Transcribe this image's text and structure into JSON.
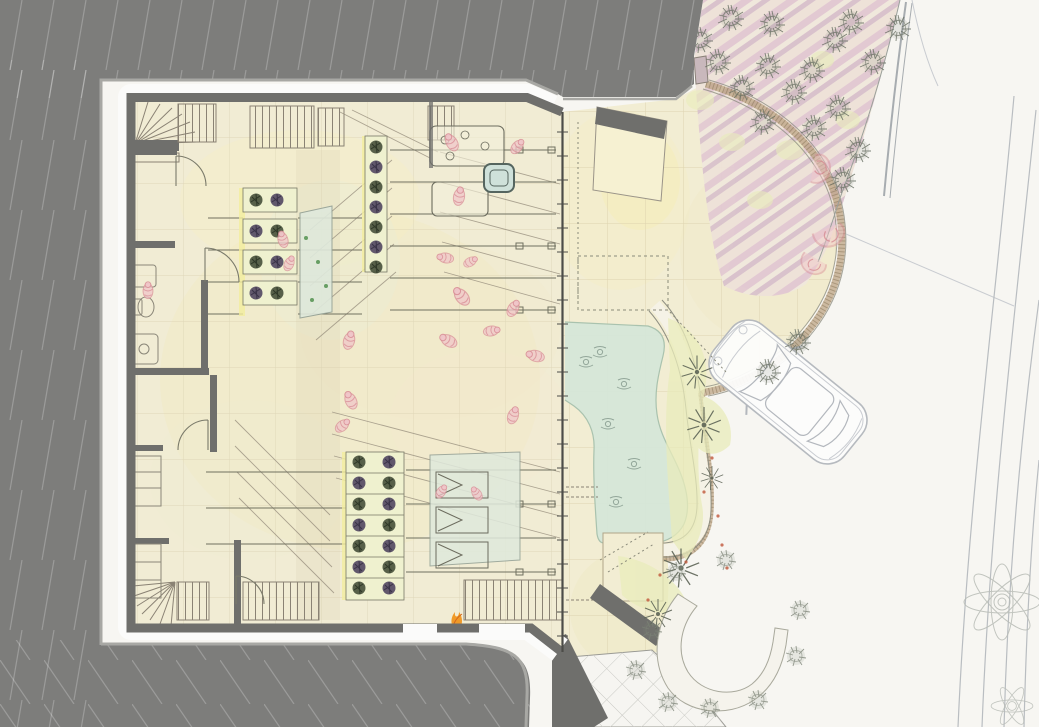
{
  "meta": {
    "title": "hand-rendered architectural site plan",
    "canvas": {
      "width": 1039,
      "height": 727
    },
    "drawing_type": "ground-floor plan with landscape, watercolor and pencil rendering"
  },
  "palette": {
    "white": "#f7f6f2",
    "hill": "#7d7d7b",
    "hill_line": "rgba(250,250,250,0.24)",
    "hill_edge": "#a8a8a4",
    "halo": "#fbfbfa",
    "wall": "#6f6f6c",
    "glazing": "#4c4c48",
    "floor": "#f1ecd4",
    "floor_line": "#d5cbab",
    "terrace": "#f2edd3",
    "terrace_line": "#d6cba6",
    "pond": "#d5e7d8",
    "pond_edge": "#a9c2ae",
    "path": "#f5f2e6",
    "path_edge": "#8f8f82",
    "band": "#b99f7e",
    "band_dot": "#8d7a5c",
    "pink1": "#eee2d8",
    "pink2": "#e2c9d2",
    "pink3": "#f0e8dc",
    "pink4": "#d9c2cc",
    "planting": "#e9ecbb",
    "planter_bed": "#eff1cf",
    "planter_glow": "#f2ee9e",
    "bush_green": "#46503a",
    "bush_purple": "#514760",
    "glass": "#dfe9dc",
    "tree": "#6a7164",
    "palm": "#5d6456",
    "shrub": "#7c8376",
    "people": "#d98f97",
    "people_fill": "#f0c6c9",
    "fire": "#f09a28",
    "fire_dark": "#d2661e",
    "car_line": "#b3b7bd",
    "pencil": "#c9ccd1",
    "road_line": "#b9bdc1",
    "curb": "#a7acb0",
    "stair": "#8a8274",
    "rail": "#70705f",
    "door": "#7a7a6a",
    "dash": "#8a8a7a",
    "grid_path": "#c9c9c4",
    "reddot": "#c0563a",
    "pillar": "#c9b8bc"
  },
  "legend": {
    "regions": [
      {
        "name": "hillside",
        "fill": "hill"
      },
      {
        "name": "building-interior",
        "fill": "floor"
      },
      {
        "name": "terrace",
        "fill": "terrace"
      },
      {
        "name": "pond",
        "fill": "pond"
      },
      {
        "name": "pink-paved-garden",
        "fill": "pink1"
      },
      {
        "name": "driveway-road",
        "fill": "white"
      },
      {
        "name": "planting-beds",
        "fill": "planting"
      }
    ],
    "counts": {
      "cars": 1,
      "ponds": 1,
      "fan_stairs": 2,
      "planter_clusters": 3
    }
  },
  "veg": {
    "trees_pink": [
      [
        718,
        62
      ],
      [
        768,
        66
      ],
      [
        742,
        88
      ],
      [
        794,
        92
      ],
      [
        812,
        70
      ],
      [
        838,
        108
      ],
      [
        814,
        128
      ],
      [
        763,
        122
      ],
      [
        731,
        18
      ],
      [
        772,
        24
      ],
      [
        851,
        22
      ],
      [
        873,
        62
      ],
      [
        858,
        150
      ],
      [
        843,
        180
      ],
      [
        898,
        28
      ],
      [
        835,
        40
      ],
      [
        700,
        40
      ]
    ],
    "trees_curve": [
      [
        798,
        342
      ],
      [
        768,
        372
      ]
    ],
    "palms": [
      [
        697,
        372,
        1.1
      ],
      [
        704,
        425,
        1.2
      ],
      [
        681,
        568,
        1.3
      ],
      [
        658,
        614,
        1.0
      ],
      [
        712,
        478,
        0.8
      ]
    ],
    "shrubs_br": [
      [
        676,
        572
      ],
      [
        652,
        630
      ],
      [
        636,
        670
      ],
      [
        668,
        702
      ],
      [
        710,
        708
      ],
      [
        758,
        700
      ],
      [
        796,
        656
      ],
      [
        726,
        560
      ],
      [
        800,
        610
      ]
    ],
    "bushes_green": [
      [
        256,
        200
      ],
      [
        277,
        231
      ],
      [
        256,
        262
      ],
      [
        277,
        293
      ],
      [
        376,
        147
      ],
      [
        376,
        187
      ],
      [
        376,
        227
      ],
      [
        376,
        267
      ],
      [
        359,
        462
      ],
      [
        389,
        483
      ],
      [
        359,
        504
      ],
      [
        389,
        525
      ],
      [
        359,
        546
      ],
      [
        389,
        567
      ],
      [
        359,
        588
      ]
    ],
    "bushes_purple": [
      [
        277,
        200
      ],
      [
        256,
        231
      ],
      [
        277,
        262
      ],
      [
        256,
        293
      ],
      [
        376,
        167
      ],
      [
        376,
        207
      ],
      [
        376,
        247
      ],
      [
        389,
        462
      ],
      [
        359,
        483
      ],
      [
        389,
        504
      ],
      [
        359,
        525
      ],
      [
        389,
        546
      ],
      [
        359,
        567
      ],
      [
        389,
        588
      ]
    ],
    "red_dots": [
      [
        712,
        458
      ],
      [
        718,
        516
      ],
      [
        727,
        568
      ],
      [
        704,
        492
      ],
      [
        722,
        545
      ],
      [
        660,
        575
      ],
      [
        686,
        562
      ],
      [
        648,
        600
      ]
    ]
  },
  "figures": {
    "people": [
      [
        452,
        143,
        1,
        -30
      ],
      [
        517,
        147,
        0.9,
        40
      ],
      [
        459,
        197,
        1,
        10
      ],
      [
        446,
        258,
        0.9,
        -80
      ],
      [
        470,
        262,
        0.8,
        60
      ],
      [
        283,
        240,
        0.9,
        -15
      ],
      [
        289,
        264,
        0.85,
        25
      ],
      [
        462,
        297,
        1.1,
        -40
      ],
      [
        513,
        309,
        0.95,
        30
      ],
      [
        491,
        331,
        0.9,
        80
      ],
      [
        449,
        341,
        1,
        -60
      ],
      [
        349,
        341,
        1,
        15
      ],
      [
        351,
        401,
        1,
        -25
      ],
      [
        342,
        426,
        0.9,
        50
      ],
      [
        536,
        356,
        1,
        -75
      ],
      [
        513,
        416,
        0.95,
        20
      ],
      [
        148,
        291,
        0.9,
        0
      ],
      [
        441,
        492,
        0.8,
        35
      ],
      [
        477,
        494,
        0.8,
        -35
      ]
    ],
    "swimmers": [
      [
        600,
        352
      ],
      [
        624,
        384
      ],
      [
        608,
        424
      ],
      [
        634,
        464
      ],
      [
        616,
        502
      ],
      [
        586,
        362
      ]
    ],
    "pink_seats": [
      [
        820,
        170,
        1.2,
        20
      ],
      [
        829,
        236,
        1.3,
        80
      ],
      [
        812,
        264,
        1.1,
        130
      ]
    ]
  }
}
